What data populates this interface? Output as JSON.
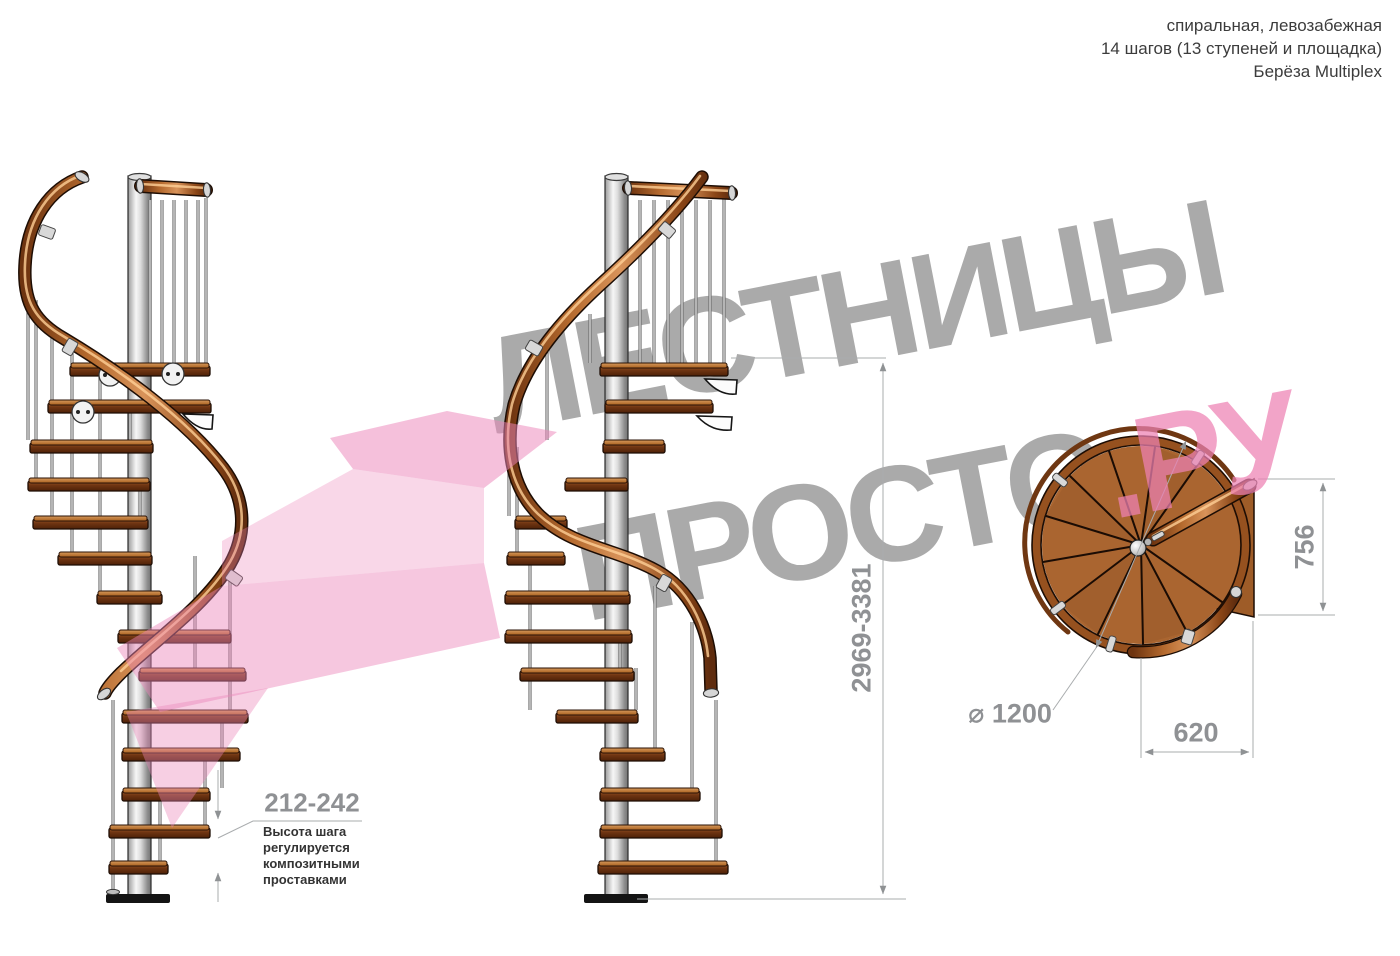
{
  "header": {
    "line1": "спиральная, левозабежная",
    "line2": "14 шагов (13 ступеней и площадка)",
    "line3": "Берёза Multiplex"
  },
  "watermark": {
    "line1": "ЛЕСТНИЦЫ",
    "line2": "ПРОСТО",
    "suffix": ".РУ"
  },
  "dimensions": {
    "total_height": "2969-3381",
    "step_height": "212-242",
    "landing_depth": "756",
    "landing_width": "620",
    "diameter": "⌀ 1200"
  },
  "note": "Высота шага\nрегулируется\nкомпозитными\nпроставками",
  "stairs_info": {
    "views": [
      "side view A",
      "side view B",
      "top plan view"
    ],
    "steps_total": 14,
    "treads": 13,
    "landing": 1
  },
  "colors": {
    "text": "#3c3c3c",
    "note": "#333333",
    "dim": "#8f9194",
    "wm-gray": "#9e9e9e",
    "wm-pink": "#ee82b4",
    "pink-arrow": "#ec86ba",
    "wood": "#aa6530",
    "wood-dark": "#6e3412",
    "rail-wood": "#b56a2e",
    "steel": "#d9d9d9"
  }
}
